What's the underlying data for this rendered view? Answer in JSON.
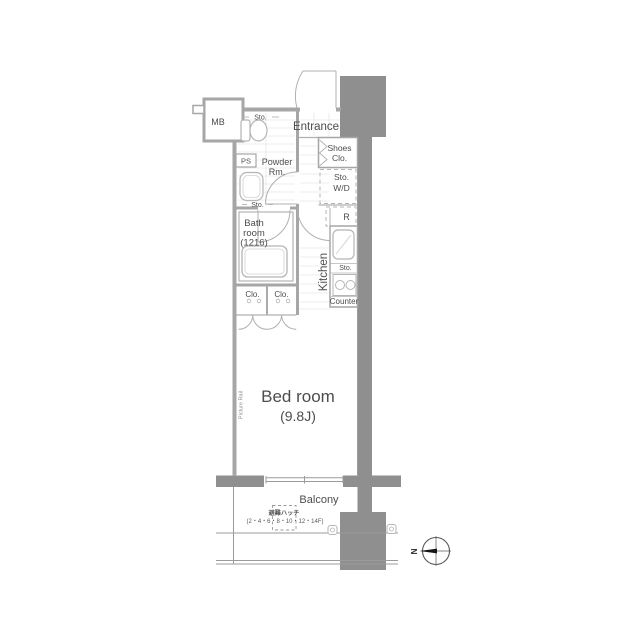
{
  "plan_type": "apartment-floor-plan",
  "labels": {
    "mb": "MB",
    "toilet_sto": "Sto.",
    "ps": "PS",
    "powder": [
      "Powder",
      "Rm."
    ],
    "basin_sto": "Sto.",
    "bath": [
      "Bath",
      "room",
      "(1216)"
    ],
    "entrance": "Entrance",
    "shoes_clo": [
      "Shoes",
      "Clo."
    ],
    "sto_wd": [
      "Sto.",
      "W/D"
    ],
    "fridge": "R",
    "kitchen": "Kitchen",
    "kitchen_sto": "Sto.",
    "counter": "Counter",
    "clo_left": "Clo.",
    "clo_right": "Clo.",
    "bedroom_name": "Bed room",
    "bedroom_size": "(9.8J)",
    "picture_rail": "Picture Rail",
    "balcony": "Balcony",
    "hatch_name": "避難ハッチ",
    "hatch_floors": "(2・4・6・8・10・12・14F)",
    "compass_north": "N"
  },
  "colors": {
    "pillar": "#8f8f8f",
    "wall": "#a6a6a6",
    "fixture": "#b5b5b5",
    "text": "#4d4d4d",
    "background": "#ffffff"
  }
}
